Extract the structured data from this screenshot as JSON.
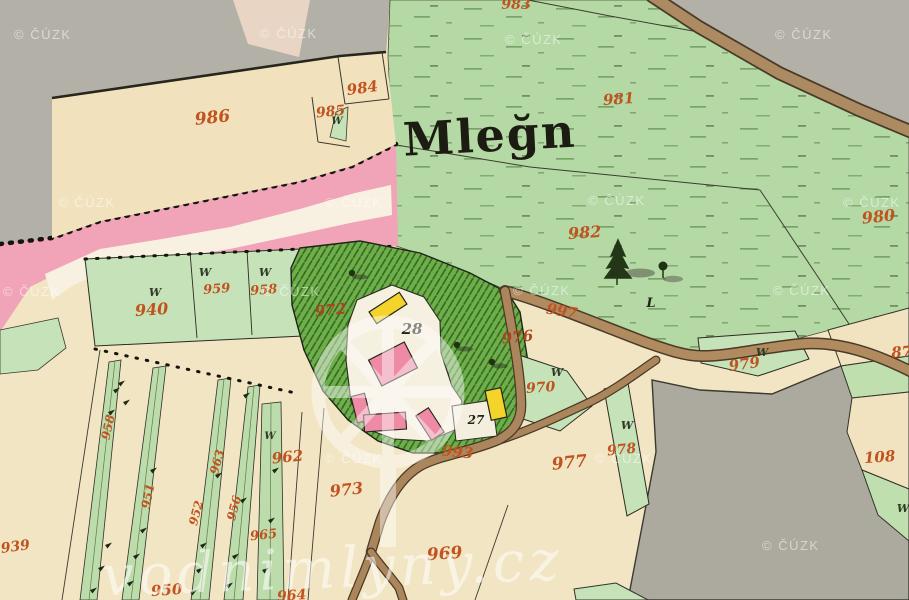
{
  "map": {
    "title": {
      "text": "Mleğn"
    },
    "watermarks": {
      "cuzk": {
        "text": "© ČÚZK",
        "color": "rgba(255,255,255,0.5)",
        "positions": [
          [
            14,
            39
          ],
          [
            260,
            38
          ],
          [
            505,
            44
          ],
          [
            775,
            39
          ],
          [
            58,
            207
          ],
          [
            325,
            207
          ],
          [
            588,
            205
          ],
          [
            843,
            207
          ],
          [
            3,
            296
          ],
          [
            263,
            296
          ],
          [
            513,
            295
          ],
          [
            773,
            295
          ],
          [
            325,
            463
          ],
          [
            595,
            463
          ],
          [
            762,
            550
          ]
        ]
      },
      "site": {
        "text": "vodnimlyny.cz"
      }
    },
    "parcel_labels": [
      {
        "t": "986",
        "x": 213,
        "y": 123,
        "s": 17,
        "r": -6,
        "c": "r"
      },
      {
        "t": "984",
        "x": 363,
        "y": 93,
        "s": 15,
        "r": -8,
        "c": "r"
      },
      {
        "t": "985",
        "x": 331,
        "y": 116,
        "s": 14,
        "r": -6,
        "c": "r"
      },
      {
        "t": "983",
        "x": 516,
        "y": 9,
        "s": 14,
        "r": 0,
        "c": "r"
      },
      {
        "t": "981",
        "x": 619,
        "y": 104,
        "s": 15,
        "r": -4,
        "c": "r"
      },
      {
        "t": "982",
        "x": 585,
        "y": 238,
        "s": 16,
        "r": -4,
        "c": "r"
      },
      {
        "t": "980",
        "x": 879,
        "y": 222,
        "s": 16,
        "r": -6,
        "c": "r"
      },
      {
        "t": "940",
        "x": 152,
        "y": 315,
        "s": 16,
        "r": -4,
        "c": "r"
      },
      {
        "t": "959",
        "x": 217,
        "y": 293,
        "s": 13,
        "r": -4,
        "c": "r"
      },
      {
        "t": "958",
        "x": 264,
        "y": 294,
        "s": 13,
        "r": -4,
        "c": "r"
      },
      {
        "t": "972",
        "x": 331,
        "y": 315,
        "s": 15,
        "r": -6,
        "c": "d"
      },
      {
        "t": "976",
        "x": 518,
        "y": 342,
        "s": 15,
        "r": -6,
        "c": "d"
      },
      {
        "t": "997",
        "x": 561,
        "y": 316,
        "s": 15,
        "r": 10,
        "c": "r"
      },
      {
        "t": "970",
        "x": 541,
        "y": 392,
        "s": 14,
        "r": -4,
        "c": "r"
      },
      {
        "t": "993",
        "x": 457,
        "y": 457,
        "s": 15,
        "r": 6,
        "c": "r"
      },
      {
        "t": "979",
        "x": 745,
        "y": 369,
        "s": 15,
        "r": -8,
        "c": "r"
      },
      {
        "t": "977",
        "x": 570,
        "y": 468,
        "s": 17,
        "r": -6,
        "c": "r"
      },
      {
        "t": "978",
        "x": 622,
        "y": 454,
        "s": 14,
        "r": -6,
        "c": "r"
      },
      {
        "t": "962",
        "x": 288,
        "y": 462,
        "s": 15,
        "r": -6,
        "c": "r"
      },
      {
        "t": "973",
        "x": 347,
        "y": 495,
        "s": 16,
        "r": -6,
        "c": "r"
      },
      {
        "t": "969",
        "x": 445,
        "y": 559,
        "s": 17,
        "r": -4,
        "c": "r"
      },
      {
        "t": "965",
        "x": 264,
        "y": 539,
        "s": 13,
        "r": -6,
        "c": "r"
      },
      {
        "t": "950",
        "x": 167,
        "y": 595,
        "s": 15,
        "r": -4,
        "c": "r"
      },
      {
        "t": "939",
        "x": 16,
        "y": 551,
        "s": 14,
        "r": -8,
        "c": "r"
      },
      {
        "t": "964",
        "x": 292,
        "y": 600,
        "s": 14,
        "r": -4,
        "c": "r"
      },
      {
        "t": "108",
        "x": 880,
        "y": 462,
        "s": 15,
        "r": -4,
        "c": "r"
      },
      {
        "t": "87",
        "x": 902,
        "y": 357,
        "s": 15,
        "r": -4,
        "c": "r"
      },
      {
        "t": "958",
        "x": 112,
        "y": 428,
        "s": 12,
        "r": -78,
        "c": "r"
      },
      {
        "t": "951",
        "x": 152,
        "y": 497,
        "s": 12,
        "r": -78,
        "c": "r"
      },
      {
        "t": "963",
        "x": 221,
        "y": 463,
        "s": 12,
        "r": -75,
        "c": "r"
      },
      {
        "t": "952",
        "x": 200,
        "y": 514,
        "s": 12,
        "r": -75,
        "c": "r"
      },
      {
        "t": "956",
        "x": 238,
        "y": 509,
        "s": 12,
        "r": -75,
        "c": "r"
      },
      {
        "t": "28",
        "x": 412,
        "y": 334,
        "s": 15,
        "r": 0,
        "c": "k"
      },
      {
        "t": "27",
        "x": 476,
        "y": 424,
        "s": 12,
        "r": 0,
        "c": "k"
      },
      {
        "t": "L",
        "x": 651,
        "y": 307,
        "s": 13,
        "r": 0,
        "c": "k"
      }
    ],
    "tree_symbols": {
      "glyph": "W",
      "positions": [
        [
          155,
          296,
          11
        ],
        [
          205,
          276,
          11
        ],
        [
          265,
          276,
          11
        ],
        [
          337,
          124,
          10
        ],
        [
          557,
          376,
          11
        ],
        [
          627,
          429,
          11
        ],
        [
          762,
          356,
          11
        ],
        [
          903,
          512,
          11
        ],
        [
          270,
          439,
          10
        ]
      ]
    },
    "strip_tree_marks": [
      [
        113,
        390
      ],
      [
        118,
        383
      ],
      [
        123,
        402
      ],
      [
        108,
        412
      ],
      [
        105,
        545
      ],
      [
        98,
        568
      ],
      [
        90,
        590
      ],
      [
        150,
        470
      ],
      [
        140,
        530
      ],
      [
        133,
        556
      ],
      [
        127,
        583
      ],
      [
        215,
        475
      ],
      [
        200,
        545
      ],
      [
        196,
        570
      ],
      [
        190,
        592
      ],
      [
        240,
        500
      ],
      [
        232,
        556
      ],
      [
        226,
        585
      ],
      [
        272,
        470
      ],
      [
        268,
        520
      ],
      [
        262,
        570
      ],
      [
        243,
        395
      ]
    ],
    "colors": {
      "offmap_gray": "#b3b1a7",
      "meadow_green": "#b4d9a5",
      "parcel_green": "#c6e2b8",
      "garden_green": "#6fae4b",
      "garden_hatch": "#2f6a1e",
      "field_cream": "#f2e5c3",
      "pond_pink": "#f1a4b8",
      "stripe_white": "#f8f1e2",
      "building_pink": "#ee8aa4",
      "building_yellow": "#f4d32b",
      "road_brown": "#ac8a62",
      "label_red": "#c0531f",
      "label_black": "#23231a"
    }
  }
}
